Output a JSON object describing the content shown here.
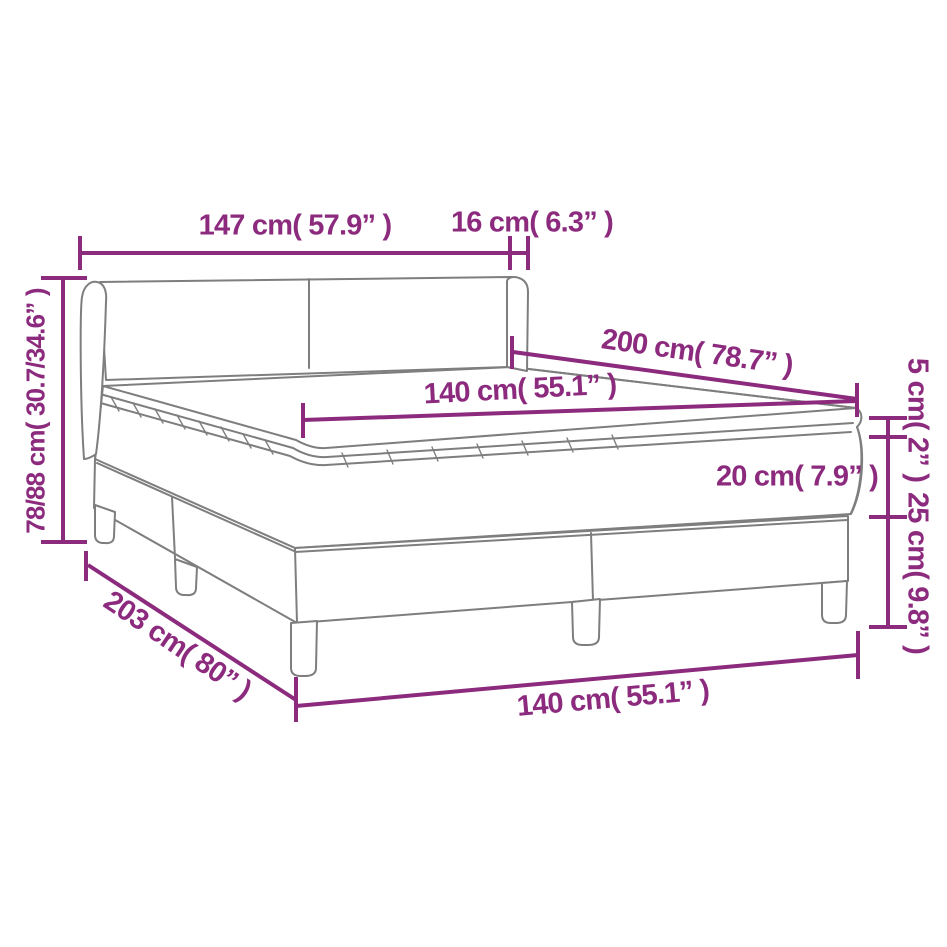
{
  "colors": {
    "dimension": "#8C2B7E",
    "outline": "#7E7E7E",
    "background": "#FFFFFF"
  },
  "measurements": {
    "headboard_width": "147 cm( 57.9” )",
    "headboard_side_depth": "16 cm( 6.3” )",
    "headboard_height": "78/88 cm( 30.7/34.6” )",
    "bed_length": "200 cm( 78.7” )",
    "mattress_width": "140 cm( 55.1” )",
    "mattress_topper_height": "5 cm( 2” )",
    "mattress_height": "20 cm( 7.9” )",
    "base_height": "25 cm( 9.8” )",
    "base_length": "203 cm( 80” )",
    "base_width": "140 cm( 55.1” )"
  }
}
